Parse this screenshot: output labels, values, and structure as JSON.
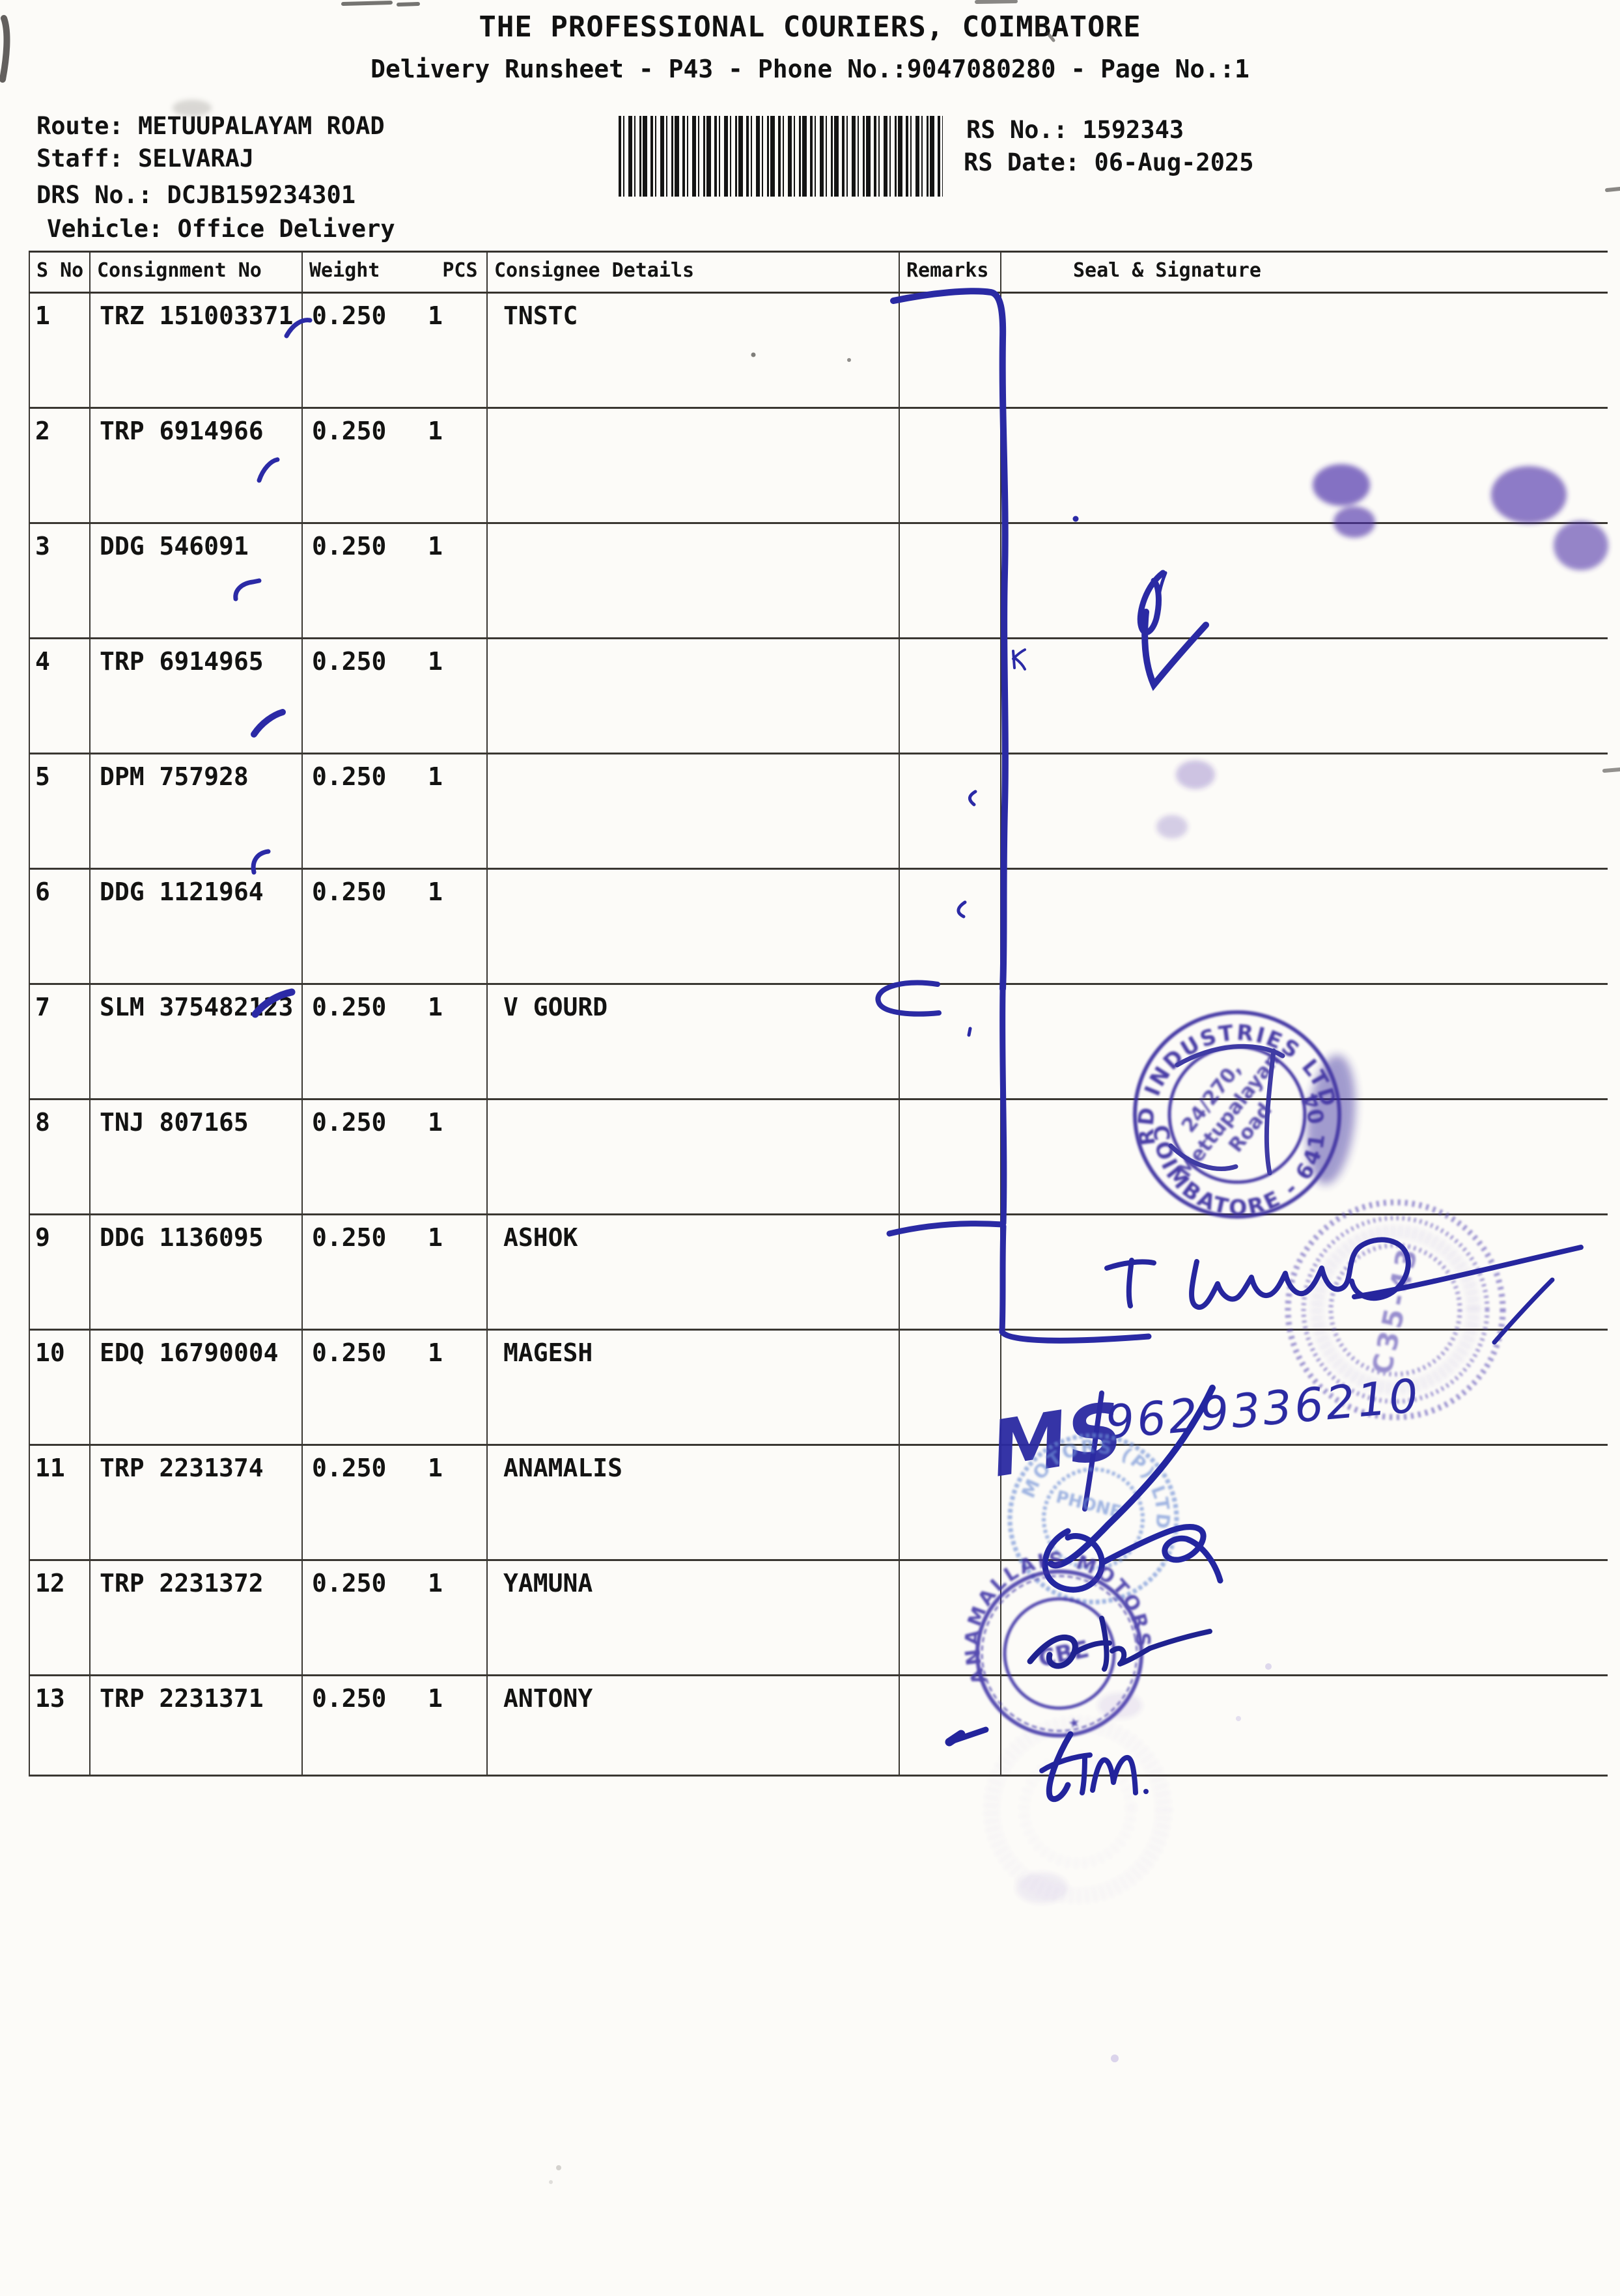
{
  "header": {
    "title": "THE PROFESSIONAL COURIERS, COIMBATORE",
    "subtitle": "Delivery Runsheet - P43 - Phone No.:9047080280 - Page No.:1",
    "route_label": "Route:",
    "route_value": "METUUPALAYAM ROAD",
    "staff_label": "Staff:",
    "staff_value": "SELVARAJ",
    "drs_label": "DRS No.:",
    "drs_value": "DCJB159234301",
    "vehicle_label": "Vehicle:",
    "vehicle_value": "Office Delivery",
    "rs_no_label": "RS No.:",
    "rs_no_value": "1592343",
    "rs_date_label": "RS Date:",
    "rs_date_value": "06-Aug-2025",
    "barcode_icon": "code128-barcode"
  },
  "table": {
    "headers": {
      "s_no": "S No",
      "consignment_no": "Consignment No",
      "weight": "Weight",
      "pcs": "PCS",
      "consignee": "Consignee Details",
      "remarks": "Remarks",
      "seal": "Seal & Signature"
    },
    "rows": [
      {
        "s_no": "1",
        "consignment_no": "TRZ 151003371",
        "weight": "0.250",
        "pcs": "1",
        "consignee": "TNSTC",
        "remarks": "",
        "seal": ""
      },
      {
        "s_no": "2",
        "consignment_no": "TRP 6914966",
        "weight": "0.250",
        "pcs": "1",
        "consignee": "",
        "remarks": "",
        "seal": ""
      },
      {
        "s_no": "3",
        "consignment_no": "DDG 546091",
        "weight": "0.250",
        "pcs": "1",
        "consignee": "",
        "remarks": "",
        "seal": ""
      },
      {
        "s_no": "4",
        "consignment_no": "TRP 6914965",
        "weight": "0.250",
        "pcs": "1",
        "consignee": "",
        "remarks": "",
        "seal": ""
      },
      {
        "s_no": "5",
        "consignment_no": "DPM 757928",
        "weight": "0.250",
        "pcs": "1",
        "consignee": "",
        "remarks": "",
        "seal": ""
      },
      {
        "s_no": "6",
        "consignment_no": "DDG 1121964",
        "weight": "0.250",
        "pcs": "1",
        "consignee": "",
        "remarks": "",
        "seal": ""
      },
      {
        "s_no": "7",
        "consignment_no": "SLM 375482123",
        "weight": "0.250",
        "pcs": "1",
        "consignee": "V GOURD",
        "remarks": "",
        "seal": ""
      },
      {
        "s_no": "8",
        "consignment_no": "TNJ 807165",
        "weight": "0.250",
        "pcs": "1",
        "consignee": "",
        "remarks": "",
        "seal": ""
      },
      {
        "s_no": "9",
        "consignment_no": "DDG 1136095",
        "weight": "0.250",
        "pcs": "1",
        "consignee": "ASHOK",
        "remarks": "",
        "seal": ""
      },
      {
        "s_no": "10",
        "consignment_no": "EDQ 16790004",
        "weight": "0.250",
        "pcs": "1",
        "consignee": "MAGESH",
        "remarks": "",
        "seal": ""
      },
      {
        "s_no": "11",
        "consignment_no": "TRP 2231374",
        "weight": "0.250",
        "pcs": "1",
        "consignee": "ANAMALIS",
        "remarks": "",
        "seal": ""
      },
      {
        "s_no": "12",
        "consignment_no": "TRP 2231372",
        "weight": "0.250",
        "pcs": "1",
        "consignee": "YAMUNA",
        "remarks": "",
        "seal": ""
      },
      {
        "s_no": "13",
        "consignment_no": "TRP 2231371",
        "weight": "0.250",
        "pcs": "1",
        "consignee": "ANTONY",
        "remarks": "",
        "seal": ""
      }
    ]
  },
  "ink": {
    "pen_color": "#2a2aa4",
    "stamps": {
      "vguard_ring_top": "V-GUARD INDUSTRIES LTD ★ CVD",
      "vguard_ring_bottom": "★ COIMBATORE - 641 043",
      "vguard_inner_line1": "24/270,",
      "vguard_inner_line2": "Mettupalayam",
      "vguard_inner_line3": "Road",
      "agency_center_code": "C35-43",
      "motors_light_ring": "MOTORS (P) LTD",
      "motors_light_center": "PHONE",
      "motors_dark_ring": "ANAMALLAIS MOTORS",
      "motors_dark_center": "CBE",
      "motors_dark_star": "★"
    },
    "handwriting": {
      "monogram": "MS",
      "phone_number": "9629336210"
    }
  }
}
